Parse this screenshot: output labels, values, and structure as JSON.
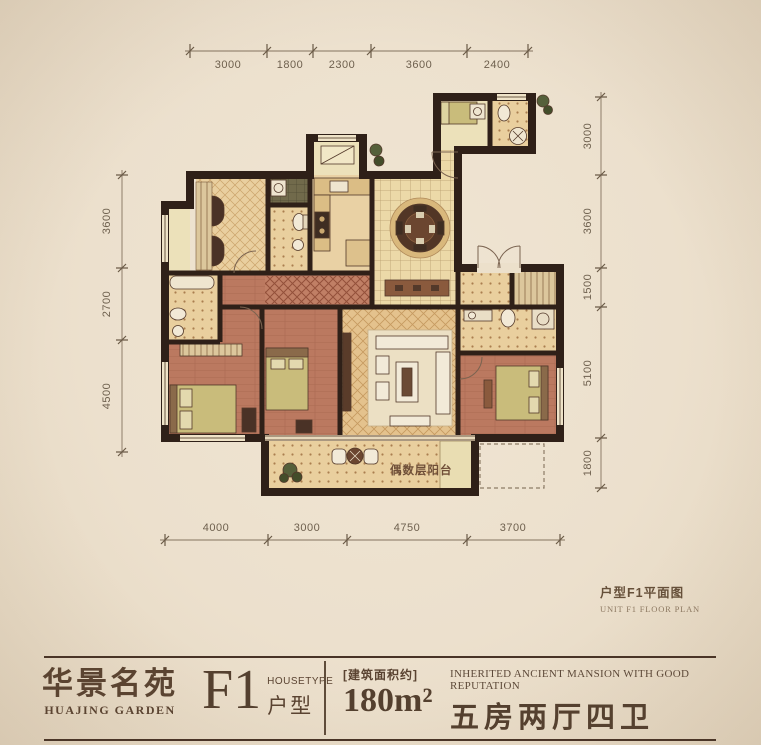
{
  "plan": {
    "balcony_label": "偶数层阳台",
    "caption_zh": "户型F1平面图",
    "caption_en": "UNIT F1 FLOOR PLAN"
  },
  "dimensions": {
    "top": [
      "3000",
      "1800",
      "2300",
      "3600",
      "2400"
    ],
    "bottom": [
      "4000",
      "3000",
      "4750",
      "3700"
    ],
    "left": [
      "3600",
      "2700",
      "4500"
    ],
    "right": [
      "3000",
      "3600",
      "1500",
      "5100",
      "1800"
    ]
  },
  "footer": {
    "project_zh": "华景名苑",
    "project_en": "HUAJING GARDEN",
    "unit_code": "F1",
    "housetype_en": "HOUSETYPE",
    "housetype_zh": "户型",
    "area_note": "[建筑面积约]",
    "area_value": "180m²",
    "slogan_en": "INHERITED ANCIENT MANSION WITH GOOD REPUTATION",
    "layout_zh": "五房两厅四卫"
  },
  "colors": {
    "paper": "#ece0cd",
    "wall": "#2f2018",
    "ink": "#5a4331",
    "dim_text": "#6e604e",
    "wood_floor": "#bb7960",
    "tile_floor": "#e4c28d",
    "bed": "#c9bc7b"
  }
}
